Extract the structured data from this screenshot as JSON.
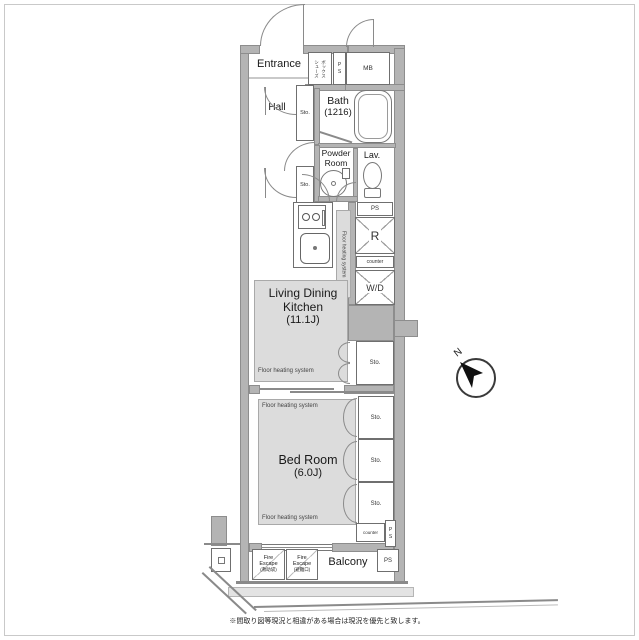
{
  "rooms": {
    "entrance": "Entrance",
    "hall": "Hall",
    "bath": "Bath",
    "bath_size": "(1216)",
    "powder_l1": "Powder",
    "powder_l2": "Room",
    "lavatory": "Lav.",
    "ldk_l1": "Living Dining",
    "ldk_l2": "Kitchen",
    "ldk_size": "(11.1J)",
    "bedroom": "Bed Room",
    "bedroom_size": "(6.0J)",
    "balcony": "Balcony"
  },
  "fixtures": {
    "meter_box": "MB",
    "pipe_shaft": "PS",
    "storage": "Sto.",
    "refrigerator": "R",
    "washer_dryer": "W/D",
    "counter": "counter",
    "floor_heating": "Floor heating system",
    "shoes_box_col1": "シューズ",
    "shoes_box_col2": "ボックス",
    "fire_escape_l1": "Fire",
    "fire_escape_l2": "Escape",
    "fire_escape_1_note": "(救助袋)",
    "fire_escape_2_note": "(避難口)"
  },
  "compass": {
    "north": "N"
  },
  "footnote": "※間取り図等現況と相違がある場合は現況を優先と致します。",
  "colors": {
    "wall": "#b4b4b4",
    "wall_edge": "#8d8d8d",
    "floor_heating_area": "#dcdcdc",
    "line": "#8a8a8a",
    "text": "#1a1a1a"
  }
}
